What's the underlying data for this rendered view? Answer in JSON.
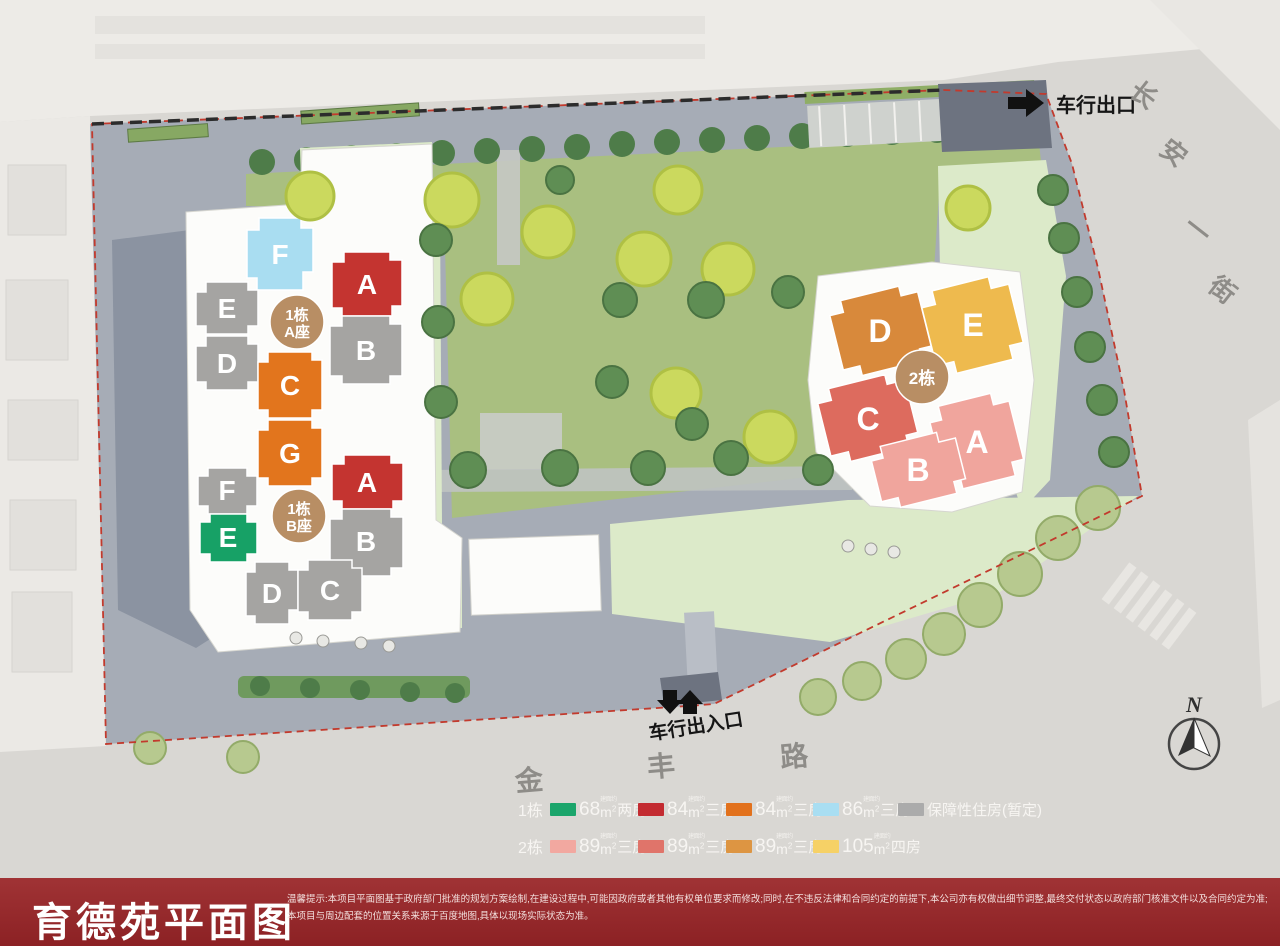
{
  "map": {
    "exit_label": "车行出口",
    "entrance_label": "车行出入口",
    "north": "N"
  },
  "roads": {
    "east": [
      "长",
      "安",
      "一",
      "街"
    ],
    "south": [
      "金",
      "丰",
      "路"
    ]
  },
  "colors": {
    "red": "#c43430",
    "orange": "#e2751d",
    "gray": "#a5a4a2",
    "light_blue": "#a9ddf1",
    "green": "#17a166",
    "tan": "#d8893b",
    "yellow": "#eeba4e",
    "salmon": "#dd6b5e",
    "pink": "#f0a59d",
    "badge": "#b88e64"
  },
  "clusters": {
    "tower1a": {
      "badge_top": "1栋",
      "badge_bottom": "A座",
      "units": {
        "f": "F",
        "e": "E",
        "d": "D",
        "a": "A",
        "b": "B",
        "c": "C",
        "g": "G"
      }
    },
    "tower1b": {
      "badge_top": "1栋",
      "badge_bottom": "B座",
      "units": {
        "f": "F",
        "e": "E",
        "a": "A",
        "b": "B",
        "d": "D",
        "c": "C"
      }
    },
    "tower2": {
      "badge": "2栋",
      "units": {
        "d": "D",
        "e": "E",
        "c": "C",
        "a": "A",
        "b": "B"
      }
    }
  },
  "legend": {
    "rows": [
      {
        "building": "1栋",
        "items": [
          {
            "color": "#1ba56b",
            "num": "68",
            "note": "建面约",
            "unit": "m",
            "exp": "2",
            "type": "两房"
          },
          {
            "color": "#c32b31",
            "num": "84",
            "note": "建面约",
            "unit": "m",
            "exp": "2",
            "type": "三房"
          },
          {
            "color": "#e2711c",
            "num": "84",
            "note": "建面约",
            "unit": "m",
            "exp": "2",
            "type": "三房"
          },
          {
            "color": "#a9def2",
            "num": "86",
            "note": "建面约",
            "unit": "m",
            "exp": "2",
            "type": "三房"
          },
          {
            "color": "#ababab",
            "text": "保障性住房(暂定)"
          }
        ]
      },
      {
        "building": "2栋",
        "items": [
          {
            "color": "#f2a8a0",
            "num": "89",
            "note": "建面约",
            "unit": "m",
            "exp": "2",
            "type": "三房"
          },
          {
            "color": "#e0746a",
            "num": "89",
            "note": "建面约",
            "unit": "m",
            "exp": "2",
            "type": "三房"
          },
          {
            "color": "#dd9542",
            "num": "89",
            "note": "建面约",
            "unit": "m",
            "exp": "2",
            "type": "三房"
          },
          {
            "color": "#f6d166",
            "num": "105",
            "note": "建面约",
            "unit": "m",
            "exp": "2",
            "type": "四房"
          }
        ]
      }
    ]
  },
  "footer": {
    "title": "育德苑平面图",
    "disclaimer": "温馨提示:本项目平面图基于政府部门批准的规划方案绘制,在建设过程中,可能因政府或者其他有权单位要求而修改;同时,在不违反法律和合同约定的前提下,本公司亦有权做出细节调整,最终交付状态以政府部门核准文件以及合同约定为准;本项目与周边配套的位置关系来源于百度地图,具体以现场实际状态为准。"
  }
}
